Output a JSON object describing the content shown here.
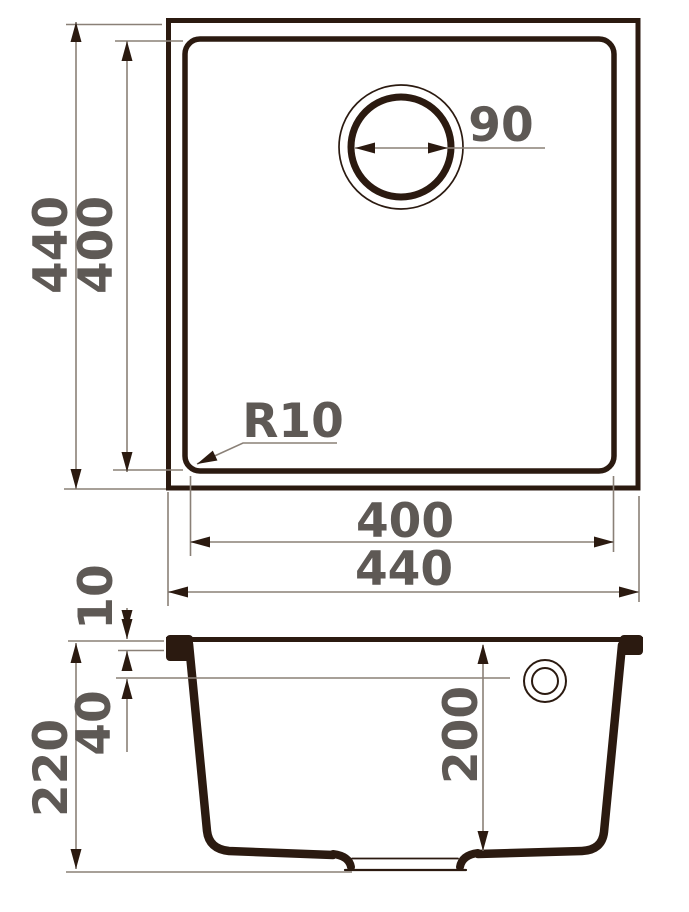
{
  "drawing": {
    "dims": {
      "top_outer_height": "440",
      "top_inner_height": "400",
      "drain_diameter": "90",
      "corner_radius": "R10",
      "top_inner_width": "400",
      "top_outer_width": "440",
      "rim_height": "10",
      "overflow_offset": "40",
      "total_depth": "220",
      "bowl_depth": "200"
    },
    "colors": {
      "ink": "#2b1a10",
      "dim_line": "#8a8077",
      "label": "#5e5955",
      "background": "#ffffff"
    }
  }
}
